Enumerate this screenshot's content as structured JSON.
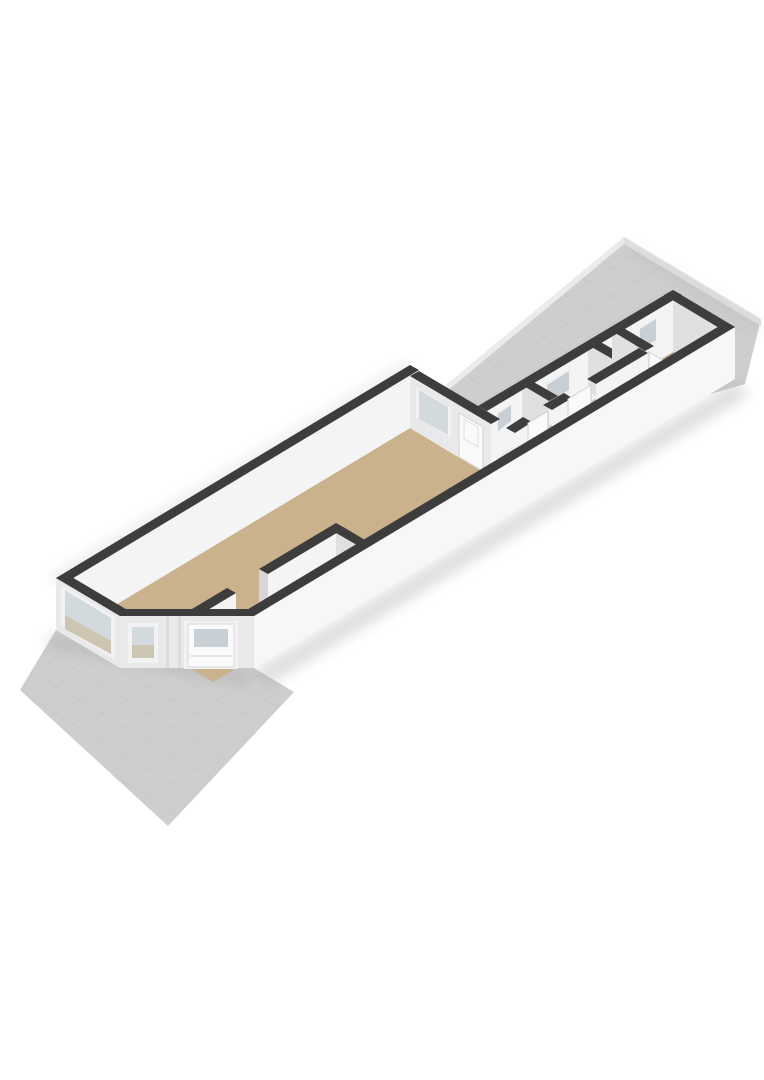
{
  "scene": {
    "type": "3d-floorplan-render",
    "view": "axonometric",
    "description": "Roofless 3D floorplan of a long narrow ground-floor dwelling seen from the south, with front yard and rear terrace",
    "rooms": [
      {
        "id": "living-room",
        "floor": "tan"
      },
      {
        "id": "entrance-hall",
        "floor": "tan"
      },
      {
        "id": "middle-hall",
        "floor": "tan"
      },
      {
        "id": "toilet",
        "floor": "pale-gray"
      },
      {
        "id": "bathroom",
        "floor": "blue-gray"
      },
      {
        "id": "closet",
        "floor": "pale-gray"
      },
      {
        "id": "back-bedroom",
        "floor": "tan-muted"
      }
    ],
    "features": [
      "bay-front-window",
      "corner-chamfer-window",
      "front-door-with-glass",
      "living-back-window",
      "living-terrace-door",
      "toilet-window",
      "bathroom-window",
      "bedroom-window",
      "interior-door-leafs",
      "front-yard-tiled-slab",
      "rear-terrace-tiled-slab"
    ]
  },
  "colors": {
    "bg": "#ffffff",
    "capDark": "#3d3d3d",
    "wallWhite": "#f7f7f8",
    "wallBright": "#f1f1f2",
    "wallLight": "#e9e9eb",
    "wallMid": "#e0e0e3",
    "wallShade": "#d6d6d9",
    "innerBright": "#f4f4f5",
    "floorTan": "#c9b28c",
    "floorTanDim": "#c3ad8e",
    "floorBlue": "#c7d1da",
    "floorPale": "#e7e9eb",
    "glass": "#d3dade",
    "glassDim": "#c8cfd5",
    "doorWhite": "#fafafa",
    "frameWhite": "#f2f2f3",
    "slab": "#cecece",
    "slabEdge": "#ebebeb",
    "slabEdge2": "#e0e0e0",
    "tileLine": "#c0c0c0",
    "shadow": "#9a9a9a"
  }
}
